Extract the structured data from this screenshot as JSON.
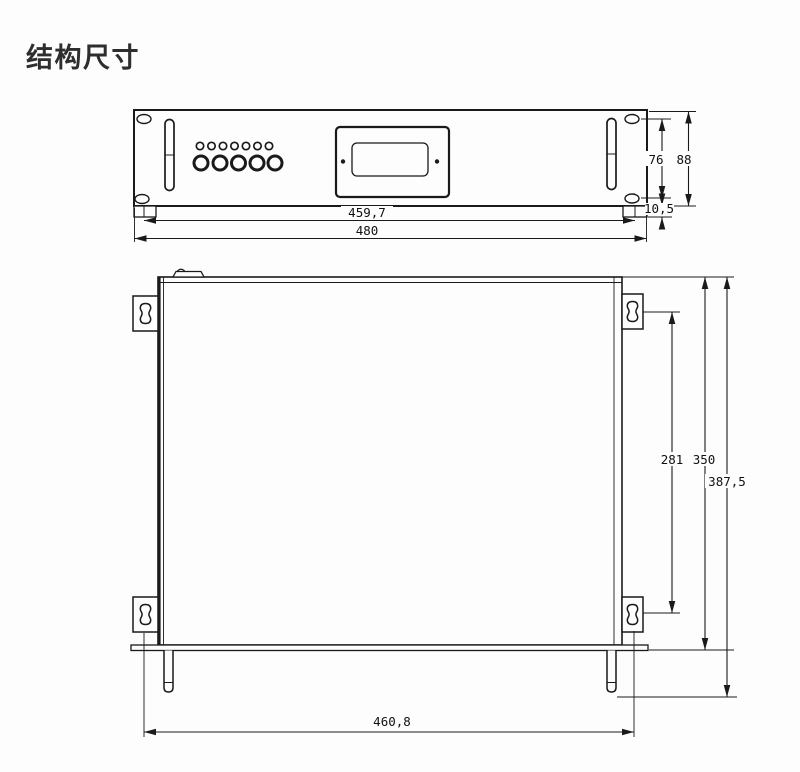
{
  "title": "结构尺寸",
  "front_view": {
    "dims": {
      "inner_width": "459,7",
      "outer_width": "480",
      "mount_hole_spacing": "76",
      "panel_height": "88",
      "lip_height": "10,5"
    }
  },
  "top_view": {
    "dims": {
      "keyhole_spacing": "281",
      "body_depth": "350",
      "overall_depth": "387,5",
      "mount_width": "460,8"
    }
  }
}
